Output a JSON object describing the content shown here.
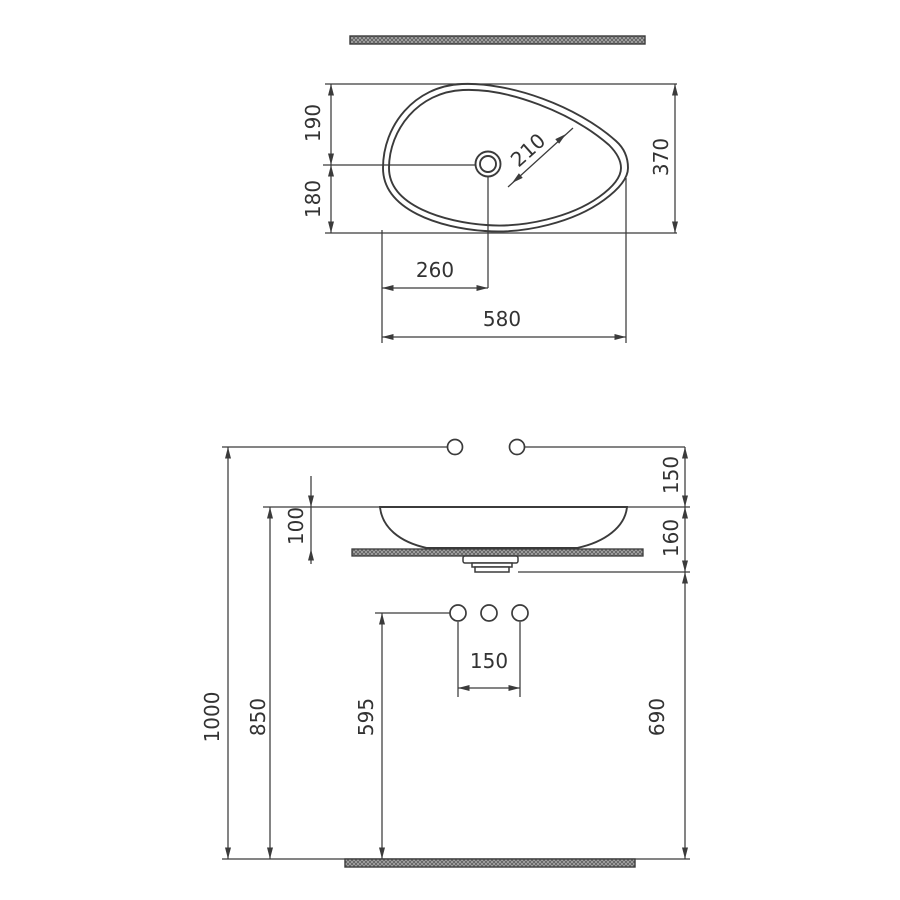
{
  "colors": {
    "line": "#3b3b3b",
    "text": "#333333",
    "hatch_base": "#b0b0b0",
    "hatch_line": "#636363"
  },
  "top_view": {
    "dims": {
      "d190": "190",
      "d180": "180",
      "d370": "370",
      "d210": "210",
      "d260": "260",
      "d580": "580"
    }
  },
  "side_view": {
    "dims": {
      "d150_wall": "150",
      "d100": "100",
      "d160": "160",
      "d1000": "1000",
      "d850": "850",
      "d595": "595",
      "d150_holes": "150",
      "d690": "690"
    }
  }
}
